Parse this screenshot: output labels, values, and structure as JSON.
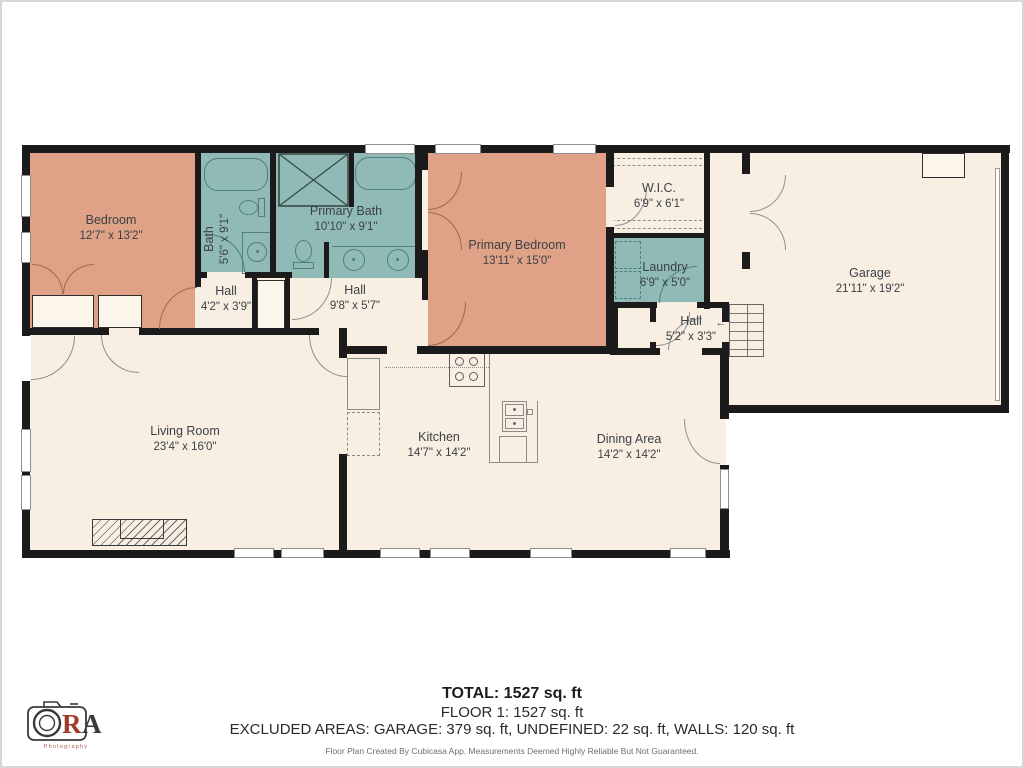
{
  "colors": {
    "floor": "#f8efe2",
    "warm_room": "#dfa286",
    "wet_room": "#8fbab6",
    "wall": "#1b1b1b",
    "label_text": "#3b4147",
    "logo_accent": "#a03b2c"
  },
  "rooms": [
    {
      "id": "bedroom",
      "label": "Bedroom",
      "dims": "12'7\" x 13'2\""
    },
    {
      "id": "bath",
      "label": "Bath",
      "dims": "5'6\" x 9'1\""
    },
    {
      "id": "primary-bath",
      "label": "Primary Bath",
      "dims": "10'10\" x 9'1\""
    },
    {
      "id": "primary-bedroom",
      "label": "Primary Bedroom",
      "dims": "13'11\" x 15'0\""
    },
    {
      "id": "wic",
      "label": "W.I.C.",
      "dims": "6'9\" x 6'1\""
    },
    {
      "id": "laundry",
      "label": "Laundry",
      "dims": "6'9\" x 5'0\""
    },
    {
      "id": "hall-a",
      "label": "Hall",
      "dims": "4'2\" x 3'9\""
    },
    {
      "id": "hall-b",
      "label": "Hall",
      "dims": "9'8\" x 5'7\""
    },
    {
      "id": "hall-c",
      "label": "Hall",
      "dims": "5'2\" x 3'3\""
    },
    {
      "id": "garage",
      "label": "Garage",
      "dims": "21'11\" x 19'2\""
    },
    {
      "id": "living-room",
      "label": "Living Room",
      "dims": "23'4\" x 16'0\""
    },
    {
      "id": "kitchen",
      "label": "Kitchen",
      "dims": "14'7\" x 14'2\""
    },
    {
      "id": "dining",
      "label": "Dining Area",
      "dims": "14'2\" x 14'2\""
    }
  ],
  "icons": {
    "stairs_direction_arrow": "←"
  },
  "footer": {
    "total": "TOTAL: 1527 sq. ft",
    "floor": "FLOOR 1: 1527 sq. ft",
    "excluded": "EXCLUDED AREAS: GARAGE: 379 sq. ft, UNDEFINED: 22 sq. ft, WALLS: 120 sq. ft",
    "disclaimer": "Floor Plan Created By Cubicasa App. Measurements Deemed Highly Reliable But Not Guaranteed."
  },
  "logo": {
    "r": "R",
    "a": "A",
    "sub": "Photography"
  }
}
